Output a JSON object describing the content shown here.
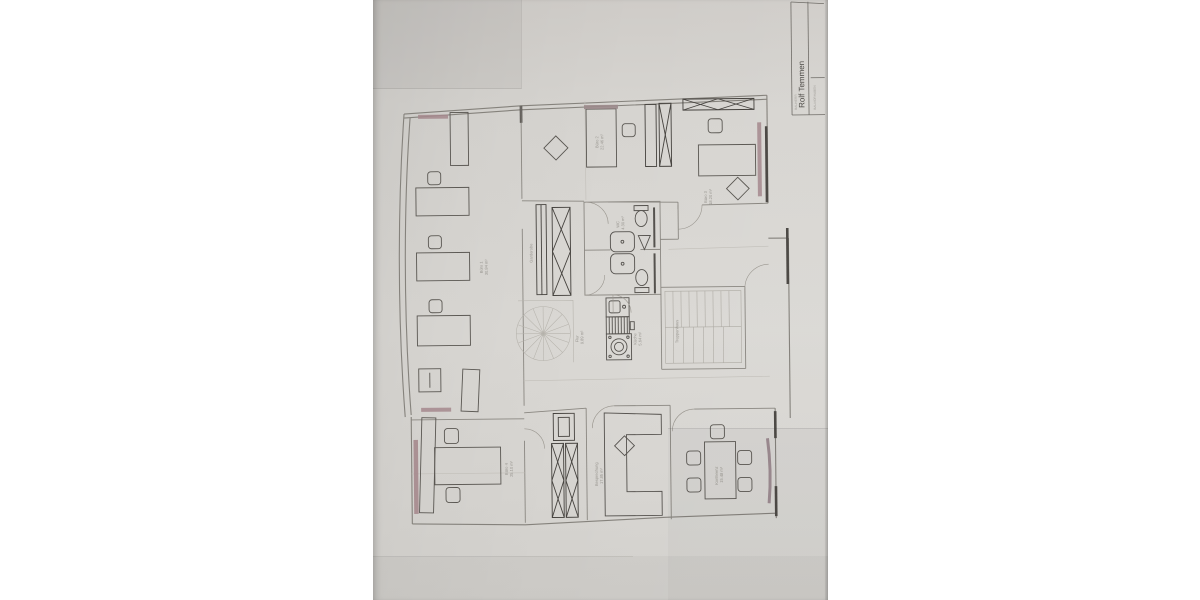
{
  "photo": {
    "background": "#ffffff",
    "paper_color": "#d7d5d1",
    "accent_pink": "#a5888d",
    "line_dark": "#55524e",
    "line_light": "#8a8781"
  },
  "title_block": {
    "owner_label": "BAUHERR",
    "owner_name": "Rolf Temmen",
    "project_label": "BAUVORHABEN"
  },
  "plan": {
    "rooms": [
      {
        "id": "buero1",
        "name": "Büro 1",
        "area": "30.84 m²"
      },
      {
        "id": "buero2",
        "name": "Büro 2",
        "area": "22.46 m²"
      },
      {
        "id": "buero3",
        "name": "Büro 3",
        "area": "18.20 m²"
      },
      {
        "id": "flur",
        "name": "Flur",
        "area": "9.89 m²"
      },
      {
        "id": "kueche",
        "name": "Küche",
        "area": "5.64 m²"
      },
      {
        "id": "wc",
        "name": "WC",
        "area": "4.30 m²"
      },
      {
        "id": "treppenhaus",
        "name": "Treppenhaus",
        "area": ""
      },
      {
        "id": "garderobe",
        "name": "Garderobe",
        "area": ""
      },
      {
        "id": "buero4",
        "name": "Büro 4",
        "area": "25.10 m²"
      },
      {
        "id": "besprechung",
        "name": "Besprechung",
        "area": "17.85 m²"
      },
      {
        "id": "konferenz",
        "name": "Konferenz",
        "area": "15.48 m²"
      }
    ]
  }
}
